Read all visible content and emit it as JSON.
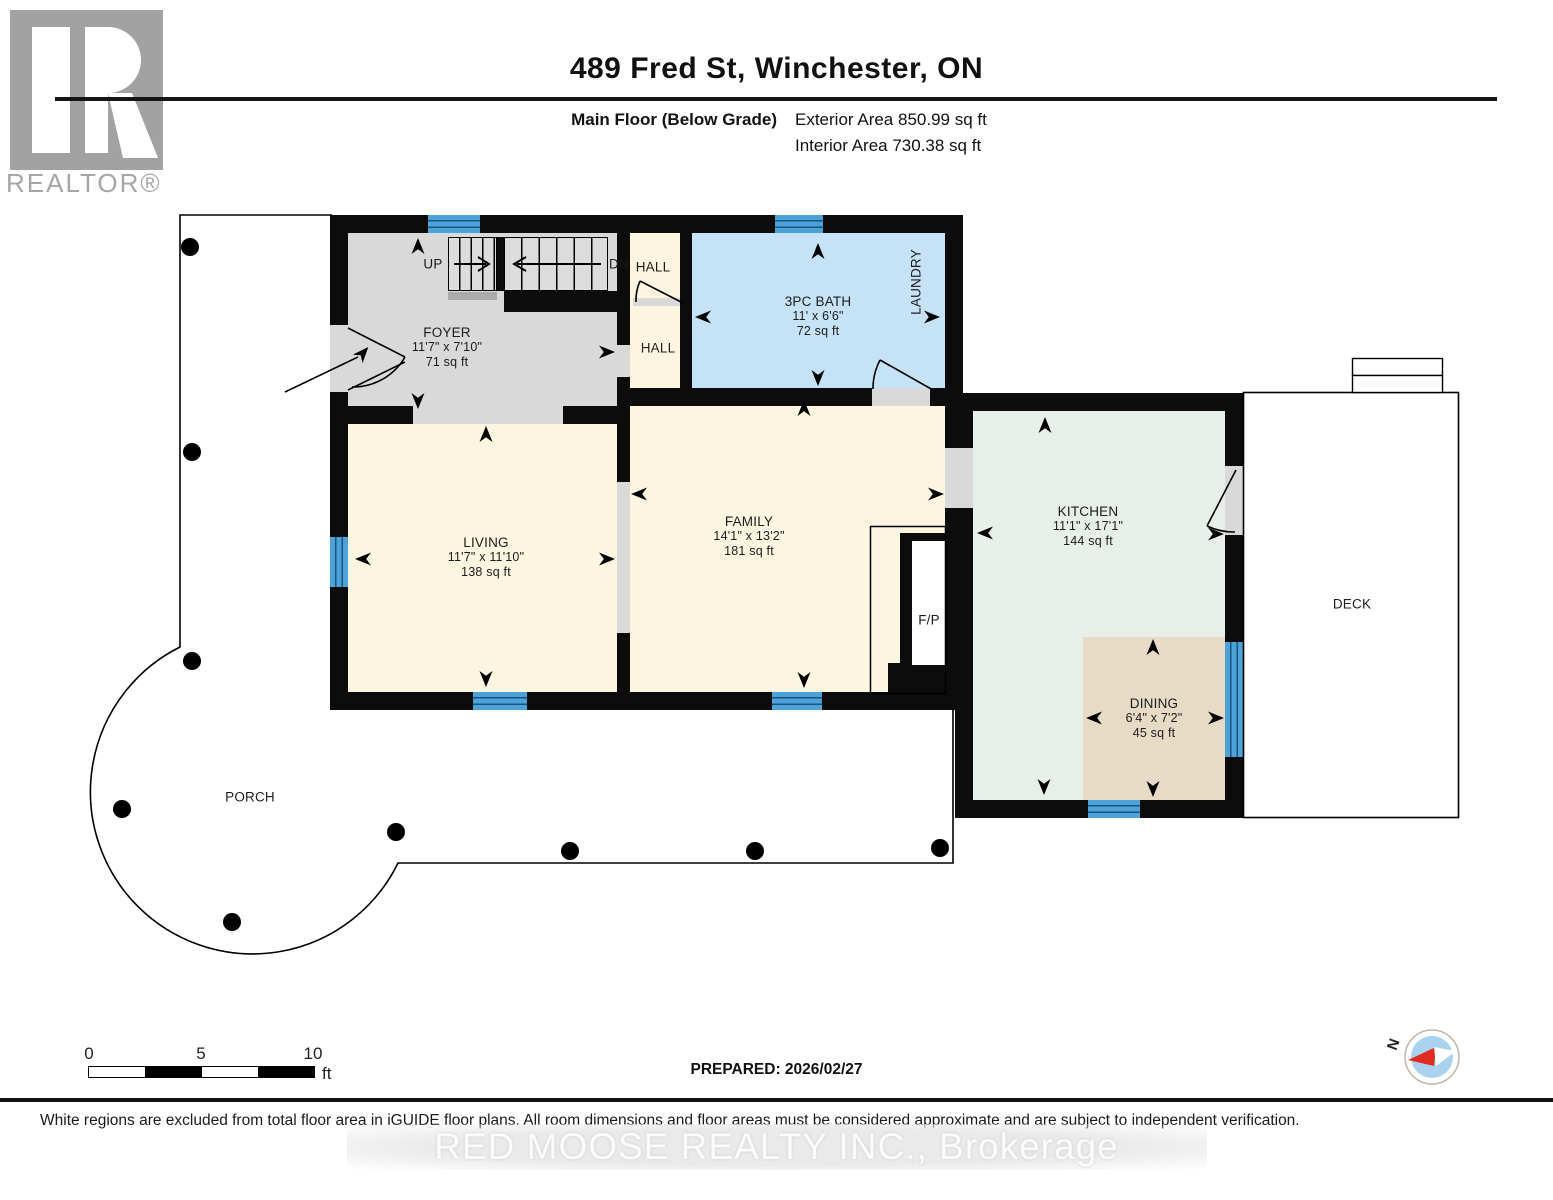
{
  "header": {
    "title": "489 Fred St, Winchester, ON",
    "floor_label": "Main Floor (Below Grade)",
    "exterior_area": "Exterior Area 850.99 sq ft",
    "interior_area": "Interior Area 730.38 sq ft"
  },
  "logo": {
    "wordmark": "REALTOR®"
  },
  "rooms": {
    "foyer": {
      "name": "FOYER",
      "dims": "11'7\" x 7'10\"",
      "area": "71 sq ft"
    },
    "hall_upper": {
      "name": "HALL"
    },
    "hall_lower": {
      "name": "HALL"
    },
    "bath": {
      "name": "3PC BATH",
      "dims": "11' x 6'6\"",
      "area": "72 sq ft"
    },
    "laundry": {
      "name": "LAUNDRY"
    },
    "living": {
      "name": "LIVING",
      "dims": "11'7\" x 11'10\"",
      "area": "138 sq ft"
    },
    "family": {
      "name": "FAMILY",
      "dims": "14'1\" x 13'2\"",
      "area": "181 sq ft"
    },
    "fireplace": {
      "name": "F/P"
    },
    "kitchen": {
      "name": "KITCHEN",
      "dims": "11'1\" x 17'1\"",
      "area": "144 sq ft"
    },
    "dining": {
      "name": "DINING",
      "dims": "6'4\" x 7'2\"",
      "area": "45 sq ft"
    },
    "deck": {
      "name": "DECK"
    },
    "porch": {
      "name": "PORCH"
    }
  },
  "stairs": {
    "up": "UP",
    "down": "DN"
  },
  "scale_bar": {
    "tick_0": "0",
    "tick_5": "5",
    "tick_10": "10",
    "unit": "ft"
  },
  "footer": {
    "prepared": "PREPARED: 2026/02/27",
    "compass_north": "N",
    "disclaimer": "White regions are excluded from total floor area in iGUIDE floor plans. All room dimensions and floor areas must be considered approximate and are subject to independent verification.",
    "watermark": "RED MOOSE REALTY INC., Brokerage"
  },
  "colors": {
    "wall": "#0c0c0c",
    "room_cream": "#fcf5e0",
    "foyer_grey": "#d9d9d9",
    "bath_blue": "#c5e2f7",
    "kitchen_green": "#e7efe8",
    "dining_tan": "#e8dbc5",
    "window_blue": "#4da3d8",
    "compass_red": "#e02b20"
  }
}
